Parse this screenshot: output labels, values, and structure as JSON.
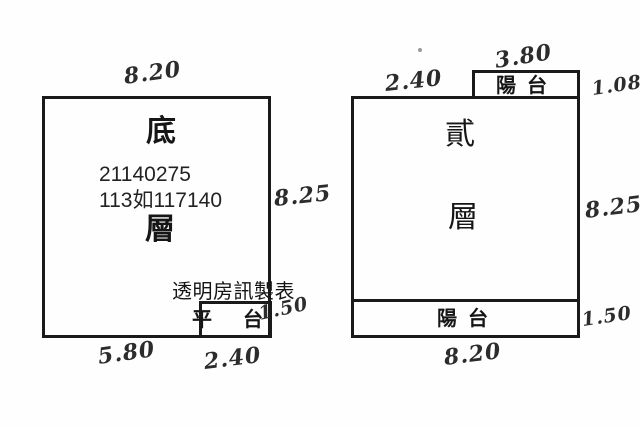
{
  "palette": {
    "ink": "#1a1a1a",
    "handwriting": "#2c2c2c",
    "paper": "#fefefe"
  },
  "left_unit": {
    "floor_label_top": "底",
    "floor_label_bottom": "層",
    "overlay_number_line1": "21140275",
    "overlay_number_line2": "113如117140",
    "watermark": "透明房訊製表",
    "platform_label": "平台",
    "dims": {
      "top_width": "8.20",
      "right_height": "8.25",
      "bottom_left_width": "5.80",
      "bottom_right_width": "2.40",
      "platform_height": "1.50"
    }
  },
  "right_unit": {
    "floor_label_top": "貳",
    "floor_label_bottom": "層",
    "top_balcony_label": "陽台",
    "bottom_balcony_label": "陽台",
    "dims": {
      "top_balcony_width": "3.80",
      "top_left_width": "2.40",
      "top_balcony_height": "1.08",
      "right_height": "8.25",
      "bottom_balcony_height": "1.50",
      "bottom_width": "8.20"
    }
  }
}
